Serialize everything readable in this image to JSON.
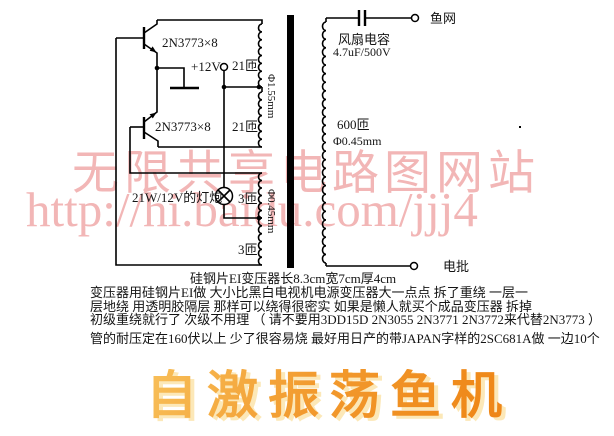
{
  "theme": {
    "line-color": "#000000",
    "text-color": "#141414",
    "watermark-color": "#f2b6b6",
    "title-grad-1": "#f8c05a",
    "title-grad-2": "#ee8414",
    "title-shadow": "#fce8b8"
  },
  "watermark": {
    "line1": "无限共享电路图网站",
    "line2": "http://hi.baidu.com/jjj4"
  },
  "schematic": {
    "q_top": "2N3773×8",
    "q_bottom": "2N3773×8",
    "supply": "+12V",
    "primary_turns_top": "21匝",
    "primary_turns_bottom": "21匝",
    "primary_wire": "Φ1.55mm",
    "lamp": "21W/12V的灯炮",
    "feedback_turns_top": "3匝",
    "feedback_turns_bottom": "3匝",
    "feedback_wire": "Φ0.45mm",
    "cap_name": "风扇电容",
    "cap_value": "4.7uF/500V",
    "terminal_top": "鱼网",
    "secondary_turns": "600匝",
    "secondary_wire": "Φ0.45mm",
    "terminal_bottom": "电批",
    "core_note": "硅钢片EI变压器长8.3cm宽7cm厚4cm"
  },
  "notes": {
    "line1": "变压器用硅钢片EI做 大小比黑白电视机电源变压器大一点点 拆了重绕 一层一",
    "line2": "层地绕 用透明胶隔层 那样可以绕得很密实 如果是懒人就买个成品变压器 拆掉",
    "line3": "初级重绕就行了 次级不用理 （ 请不要用3DD15D 2N3055 2N3771 2N3772来代替2N3773 ）",
    "line4": "管的耐压定在160伏以上 少了很容易烧 最好用日产的带JAPAN字样的2SC681A做 一边10个"
  },
  "title": {
    "text": "自激振荡鱼机"
  }
}
